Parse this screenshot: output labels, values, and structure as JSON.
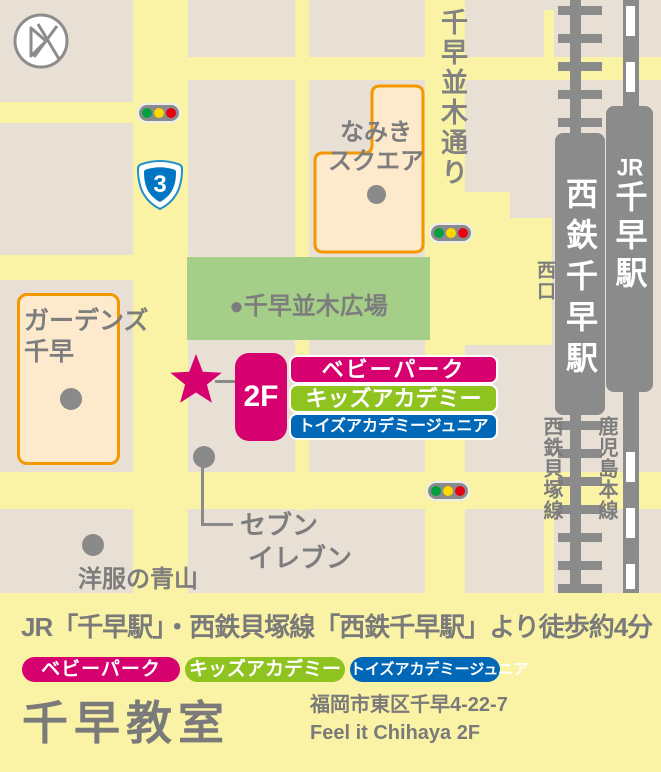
{
  "colors": {
    "road_yellow": "#faf3a5",
    "block_beige": "#e8dfd5",
    "plaza_green": "#a5cf88",
    "building_fill": "#fdeacc",
    "building_border_orange": "#f39800",
    "rail_gray": "#8b8b8b",
    "label_gray": "#7d7d7d",
    "brand_pink": "#d6006f",
    "brand_green": "#8fc31f",
    "brand_blue": "#0068b7",
    "traffic_green": "#00a040",
    "traffic_yellow": "#ffd800",
    "traffic_red": "#e60012",
    "route_shield_blue": "#0075c2"
  },
  "brands": [
    {
      "label": "ベビーパーク",
      "color": "#d6006f"
    },
    {
      "label": "キッズアカデミー",
      "color": "#8fc31f"
    },
    {
      "label": "トイズアカデミージュニア",
      "color": "#0068b7"
    }
  ],
  "map": {
    "street_name": "千早並木通り",
    "route_number": "3",
    "namiki_square_line1": "なみき",
    "namiki_square_line2": "スクエア",
    "plaza_label": "●千早並木広場",
    "gardens_line1": "ガーデンズ",
    "gardens_line2": "千早",
    "west_exit": "西口",
    "nishitetsu_station": "西鉄千早駅",
    "jr_prefix": "JR",
    "jr_station": "千早駅",
    "kaizuka_line": "西鉄貝塚線",
    "kagoshima_line": "鹿児島本線",
    "floor_label": "2F",
    "seven_eleven_line1": "セブン",
    "seven_eleven_line2": "イレブン",
    "aoyama": "洋服の青山"
  },
  "legend": {
    "access_text": "JR「千早駅」・西鉄貝塚線「西鉄千早駅」より徒歩約4分",
    "classroom_name": "千早教室",
    "address_line1": "福岡市東区千早4-22-7",
    "address_line2": "Feel it Chihaya 2F"
  }
}
